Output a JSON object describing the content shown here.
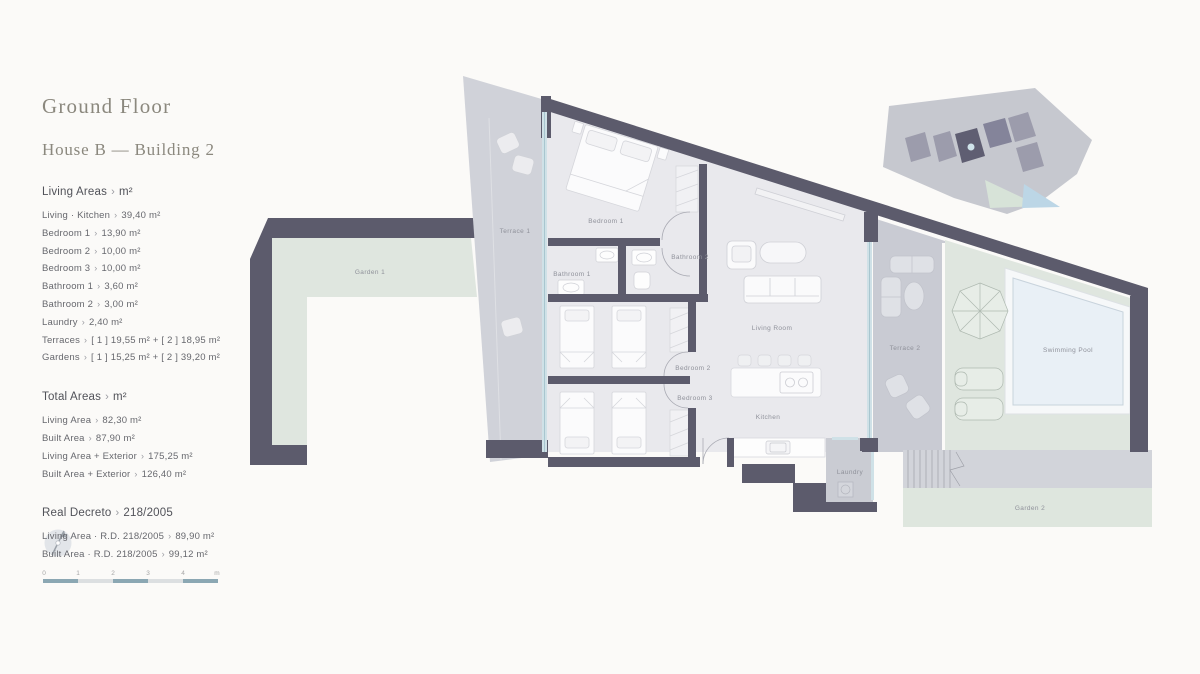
{
  "panel": {
    "title": "Ground Floor",
    "subtitle": "House B — Building 2",
    "sep": "›",
    "sections": {
      "living": {
        "heading": "Living Areas",
        "unit": "m²",
        "items": [
          {
            "label": "Living · Kitchen",
            "value": "39,40 m²"
          },
          {
            "label": "Bedroom 1",
            "value": "13,90 m²"
          },
          {
            "label": "Bedroom 2",
            "value": "10,00 m²"
          },
          {
            "label": "Bedroom 3",
            "value": "10,00 m²"
          },
          {
            "label": "Bathroom 1",
            "value": "3,60 m²"
          },
          {
            "label": "Bathroom 2",
            "value": "3,00 m²"
          },
          {
            "label": "Laundry",
            "value": "2,40 m²"
          },
          {
            "label": "Terraces",
            "value": "[ 1 ] 19,55 m²  +  [ 2 ] 18,95 m²"
          },
          {
            "label": "Gardens",
            "value": "[ 1 ] 15,25 m²  +  [ 2 ] 39,20 m²"
          }
        ]
      },
      "total": {
        "heading": "Total Areas",
        "unit": "m²",
        "items": [
          {
            "label": "Living Area",
            "value": "82,30 m²"
          },
          {
            "label": "Built Area",
            "value": "87,90 m²"
          },
          {
            "label": "Living Area + Exterior",
            "value": "175,25 m²"
          },
          {
            "label": "Built Area + Exterior",
            "value": "126,40 m²"
          }
        ]
      },
      "decreto": {
        "heading": "Real Decreto",
        "unit": "218/2005",
        "items": [
          {
            "label": "Living Area · R.D. 218/2005",
            "value": "89,90 m²"
          },
          {
            "label": "Built Area · R.D. 218/2005",
            "value": "99,12 m²"
          }
        ]
      }
    }
  },
  "scale_bar": {
    "labels": [
      "0",
      "1",
      "2",
      "3",
      "4",
      "m"
    ]
  },
  "plan": {
    "labels": {
      "terrace1": "Terrace 1",
      "garden1": "Garden 1",
      "bedroom1": "Bedroom 1",
      "bathroom1": "Bathroom 1",
      "bathroom2": "Bathroom 2",
      "bedroom2": "Bedroom 2",
      "bedroom3": "Bedroom 3",
      "living_room": "Living Room",
      "kitchen": "Kitchen",
      "laundry": "Laundry",
      "terrace2": "Terrace 2",
      "swimming_pool": "Swimming Pool",
      "garden2": "Garden 2"
    }
  },
  "colors": {
    "wall": "#5c5b6c",
    "floor": "#e9e9ed",
    "terrace": "#d0d2d9",
    "garden": "#dfe6df",
    "pool": "#e9f0f6",
    "window_glass": "#cfe1e7",
    "scale_accent": "#8ba7b3",
    "background": "#fbfaf8"
  }
}
